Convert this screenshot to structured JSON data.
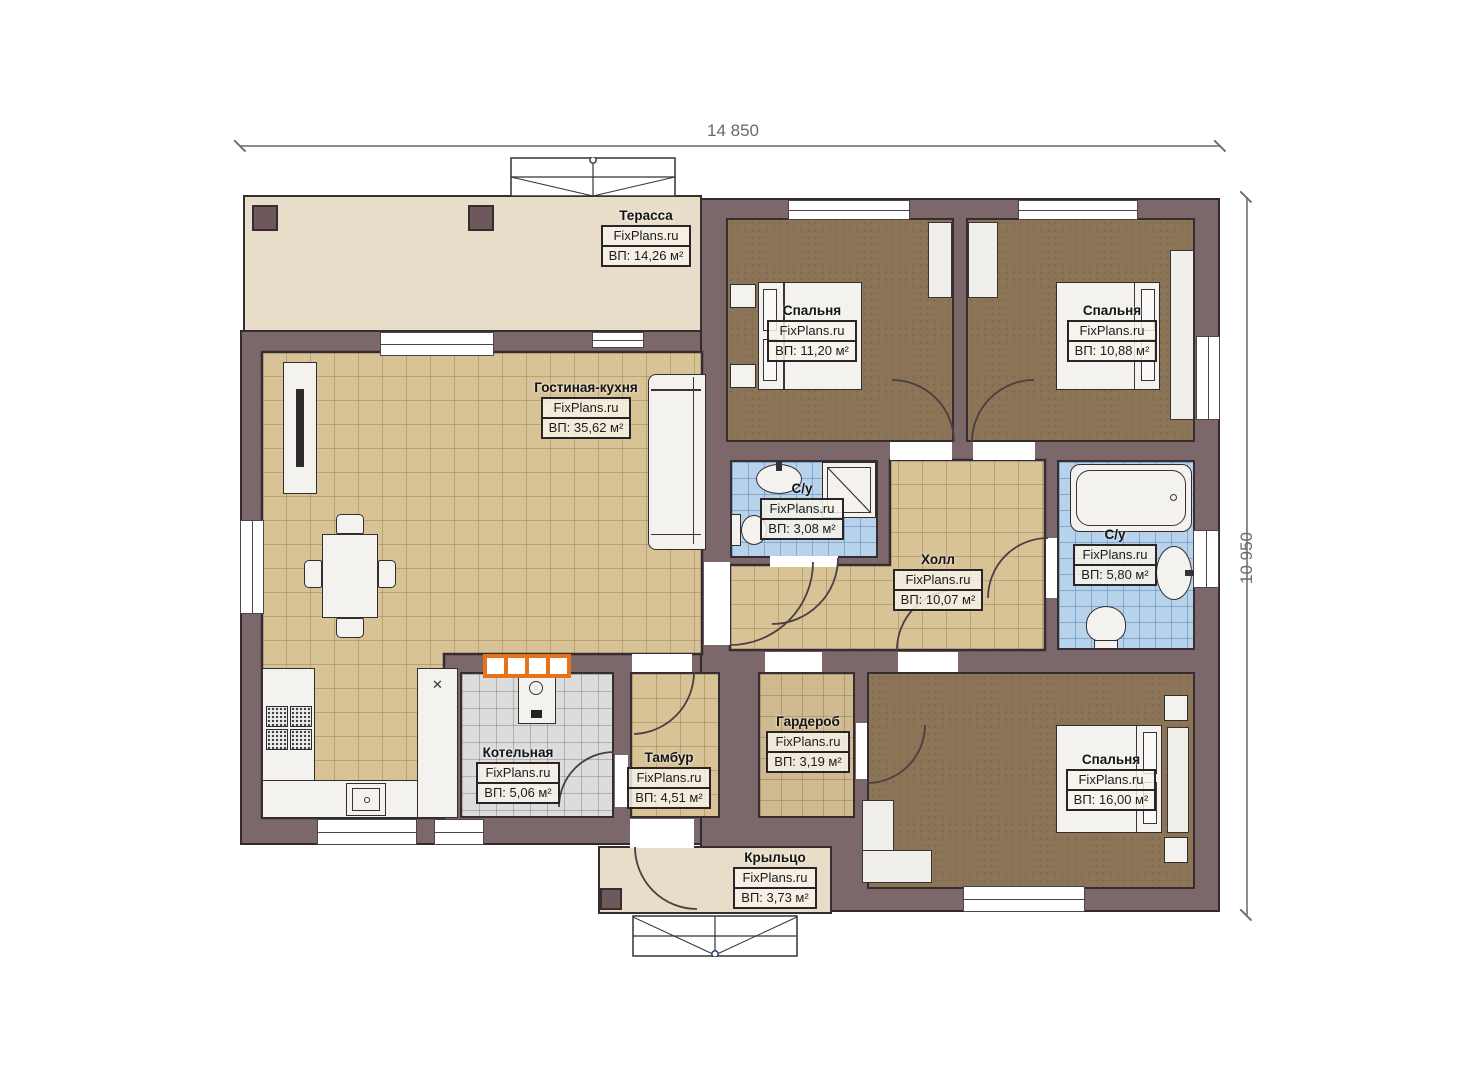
{
  "dimensions": {
    "width_label": "14 850",
    "height_label": "10 950"
  },
  "branding": {
    "site": "FixPlans.ru"
  },
  "icons": {
    "appliance_glyph": "✕"
  },
  "colors": {
    "wall": "#7c676a",
    "wall_outline": "#332a2e",
    "tile_tan": "#d8c397",
    "tile_blue": "#b7d3ec",
    "tile_gray": "#dcdcdc",
    "floor_brown": "#8c7456",
    "floor_beige": "#e8ddc8",
    "accent_orange": "#e5731c",
    "dimension_text": "#6a6a6a"
  },
  "rooms": [
    {
      "key": "terrace",
      "name": "Терасса",
      "brand": "FixPlans.ru",
      "area": "ВП: 14,26 м²"
    },
    {
      "key": "living-kitchen",
      "name": "Гостиная-кухня",
      "brand": "FixPlans.ru",
      "area": "ВП: 35,62 м²"
    },
    {
      "key": "bedroom-1",
      "name": "Спальня",
      "brand": "FixPlans.ru",
      "area": "ВП: 11,20 м²"
    },
    {
      "key": "bedroom-2",
      "name": "Спальня",
      "brand": "FixPlans.ru",
      "area": "ВП: 10,88 м²"
    },
    {
      "key": "bathroom-1",
      "name": "С/у",
      "brand": "FixPlans.ru",
      "area": "ВП: 3,08 м²"
    },
    {
      "key": "hall",
      "name": "Холл",
      "brand": "FixPlans.ru",
      "area": "ВП: 10,07 м²"
    },
    {
      "key": "bathroom-2",
      "name": "С/у",
      "brand": "FixPlans.ru",
      "area": "ВП: 5,80 м²"
    },
    {
      "key": "wardrobe",
      "name": "Гардероб",
      "brand": "FixPlans.ru",
      "area": "ВП: 3,19 м²"
    },
    {
      "key": "boiler-room",
      "name": "Котельная",
      "brand": "FixPlans.ru",
      "area": "ВП: 5,06 м²"
    },
    {
      "key": "vestibule",
      "name": "Тамбур",
      "brand": "FixPlans.ru",
      "area": "ВП: 4,51 м²"
    },
    {
      "key": "bedroom-3",
      "name": "Спальня",
      "brand": "FixPlans.ru",
      "area": "ВП: 16,00 м²"
    },
    {
      "key": "porch",
      "name": "Крыльцо",
      "brand": "FixPlans.ru",
      "area": "ВП: 3,73 м²"
    }
  ]
}
